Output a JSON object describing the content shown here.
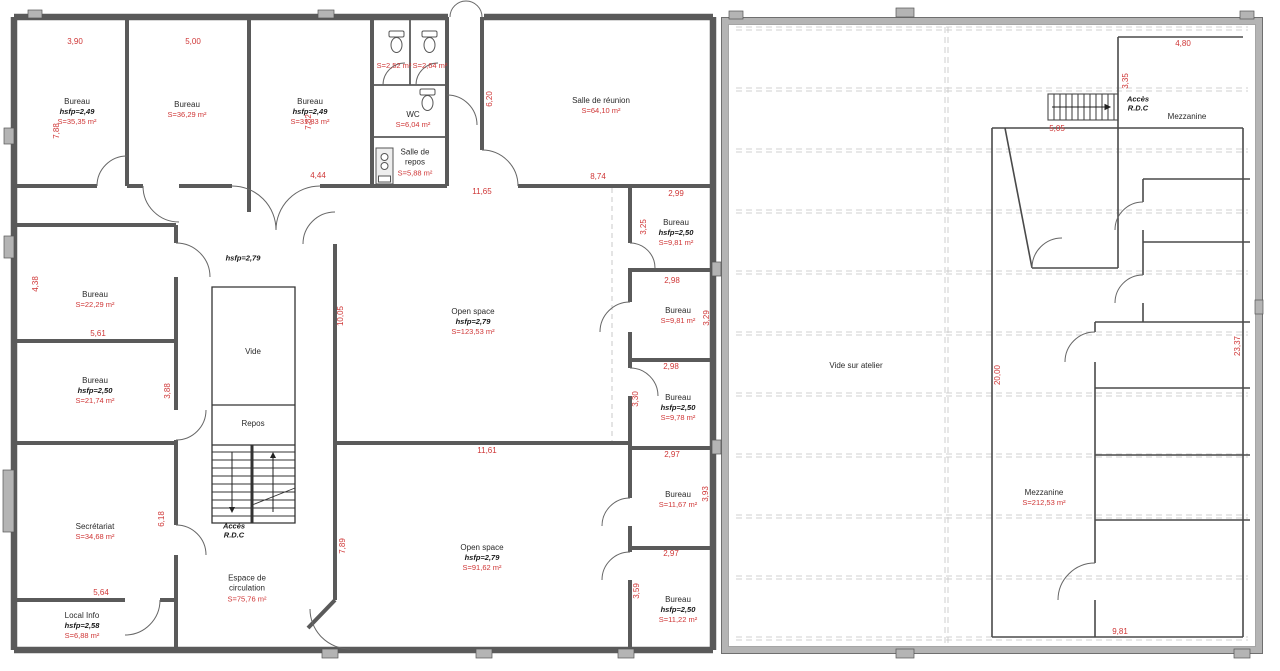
{
  "colors": {
    "dimension_text": "#cf3636",
    "room_text": "#2a2a2a",
    "wall_dark": "#5a5a5a",
    "wall_light": "#b4b4b4",
    "thin_line": "#4a4a4a",
    "dashed_line": "#c4c4c4"
  },
  "rooms": [
    {
      "id": "bureau-1",
      "name": "Bureau",
      "hsfp": "hsfp=2,49",
      "area": "S=35,35 m²"
    },
    {
      "id": "bureau-2",
      "name": "Bureau",
      "area": "S=36,29 m²"
    },
    {
      "id": "bureau-3",
      "name": "Bureau",
      "hsfp": "hsfp=2,49",
      "area": "S=31,83 m²"
    },
    {
      "id": "wc-stall-1",
      "area": "S=2,52 m²"
    },
    {
      "id": "wc-stall-2",
      "area": "S=2,64 m²"
    },
    {
      "id": "wc",
      "name": "WC",
      "area": "S=6,04 m²"
    },
    {
      "id": "salle-de-repos",
      "name": "Salle de repos",
      "area": "S=5,88 m²"
    },
    {
      "id": "salle-de-reunion",
      "name": "Salle de réunion",
      "area": "S=64,10 m²"
    },
    {
      "id": "bureau-4",
      "name": "Bureau",
      "area": "S=22,29 m²"
    },
    {
      "id": "bureau-5",
      "name": "Bureau",
      "hsfp": "hsfp=2,50",
      "area": "S=21,74 m²"
    },
    {
      "id": "secretariat",
      "name": "Secrétariat",
      "area": "S=34,68 m²"
    },
    {
      "id": "local-info",
      "name": "Local Info",
      "hsfp": "hsfp=2,58",
      "area": "S=6,88 m²"
    },
    {
      "id": "vide",
      "name": "Vide"
    },
    {
      "id": "repos",
      "name": "Repos"
    },
    {
      "id": "espace-circulation",
      "name": "Espace de circulation",
      "area": "S=75,76 m²"
    },
    {
      "id": "open-space-1",
      "name": "Open space",
      "hsfp": "hsfp=2,79",
      "area": "S=123,53 m²"
    },
    {
      "id": "open-space-2",
      "name": "Open space",
      "hsfp": "hsfp=2,79",
      "area": "S=91,62 m²"
    },
    {
      "id": "bureau-6",
      "name": "Bureau",
      "hsfp": "hsfp=2,50",
      "area": "S=9,81 m²"
    },
    {
      "id": "bureau-7",
      "name": "Bureau",
      "area": "S=9,81 m²"
    },
    {
      "id": "bureau-8",
      "name": "Bureau",
      "hsfp": "hsfp=2,50",
      "area": "S=9,78 m²"
    },
    {
      "id": "bureau-9",
      "name": "Bureau",
      "area": "S=11,67 m²"
    },
    {
      "id": "bureau-10",
      "name": "Bureau",
      "hsfp": "hsfp=2,50",
      "area": "S=11,22 m²"
    },
    {
      "id": "mezzanine-top",
      "name": "Mezzanine"
    },
    {
      "id": "vide-sur-atelier",
      "name": "Vide sur atelier"
    },
    {
      "id": "mezzanine",
      "name": "Mezzanine",
      "area": "S=212,53 m²"
    }
  ],
  "annotations": {
    "ceiling_height": "hsfp=2,79",
    "access_left_line1": "Accès",
    "access_left_line2": "R.D.C",
    "access_right_line1": "Accès",
    "access_right_line2": "R.D.C"
  },
  "dimensions": [
    "3,90",
    "5,00",
    "7,88",
    "7,82",
    "4,44",
    "6,20",
    "8,74",
    "11,65",
    "2,99",
    "3,25",
    "2,98",
    "3,29",
    "2,98",
    "3,30",
    "2,97",
    "3,93",
    "2,97",
    "3,59",
    "4,38",
    "5,61",
    "3,88",
    "6,18",
    "5,64",
    "10,05",
    "7,89",
    "11,61",
    "4,80",
    "3,35",
    "5,05",
    "20,00",
    "23,37",
    "9,81"
  ]
}
